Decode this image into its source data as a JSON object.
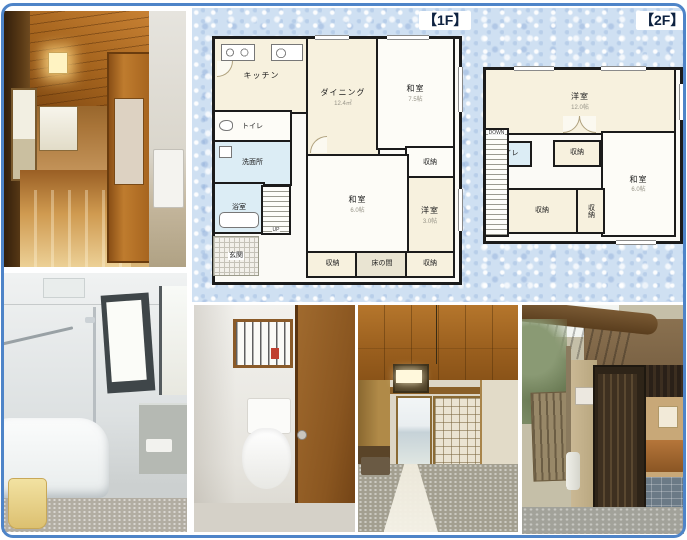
{
  "colors": {
    "page_border_blue": "#4e84c8",
    "panel_texture_blue": "#cfe0f2",
    "plan_wall_black": "#1b1b1b",
    "room_cream": "#f7f1de",
    "room_white": "#fdfcf7",
    "wet_area_blue": "#dcedf5",
    "tokonoma_beige": "#e9e4d2"
  },
  "floors": {
    "f1": {
      "title": "【1F】",
      "rooms": {
        "kitchen": {
          "label": "キッチン"
        },
        "dining": {
          "label": "ダイニング",
          "size": "12.4㎡"
        },
        "washitsu75": {
          "label": "和室",
          "size": "7.5帖"
        },
        "toilet": {
          "label": "トイレ"
        },
        "washroom": {
          "label": "洗面所"
        },
        "bath": {
          "label": "浴室"
        },
        "genkan": {
          "label": "玄関"
        },
        "stairs": {
          "label": "UP"
        },
        "washitsu6": {
          "label": "和室",
          "size": "6.0帖"
        },
        "closet_r": {
          "label": "収納"
        },
        "yoshitsu3": {
          "label": "洋室",
          "size": "3.0帖"
        },
        "closet_bl": {
          "label": "収納"
        },
        "tokonoma": {
          "label": "床の間"
        },
        "closet_br": {
          "label": "収納"
        }
      }
    },
    "f2": {
      "title": "【2F】",
      "rooms": {
        "yoshitsu12": {
          "label": "洋室",
          "size": "12.0帖"
        },
        "toilet": {
          "label": "トイレ"
        },
        "closet_t": {
          "label": "収納"
        },
        "washitsu6": {
          "label": "和室",
          "size": "6.0帖"
        },
        "closet_b": {
          "label": "収納"
        },
        "closet_v": {
          "label": "収納"
        },
        "stairs": {
          "label": "DOWN"
        }
      }
    }
  }
}
